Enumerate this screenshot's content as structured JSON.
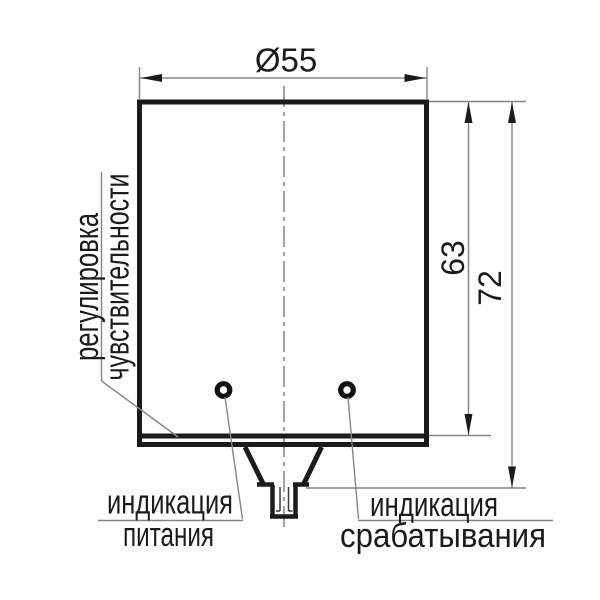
{
  "dimensions": {
    "diameter": "Ø55",
    "body_height": "63",
    "overall_height": "72"
  },
  "callouts": {
    "sensitivity": {
      "line1": "регулировка",
      "line2": "чувствительности"
    },
    "power_indicator": {
      "line1": "индикация",
      "line2": "питания"
    },
    "output_indicator": {
      "line1": "индикация",
      "line2": "срабатывания"
    }
  },
  "colors": {
    "outline": "#1b1b1b",
    "thin_line": "#858585",
    "text": "#1b1b1b",
    "background": "#ffffff"
  }
}
